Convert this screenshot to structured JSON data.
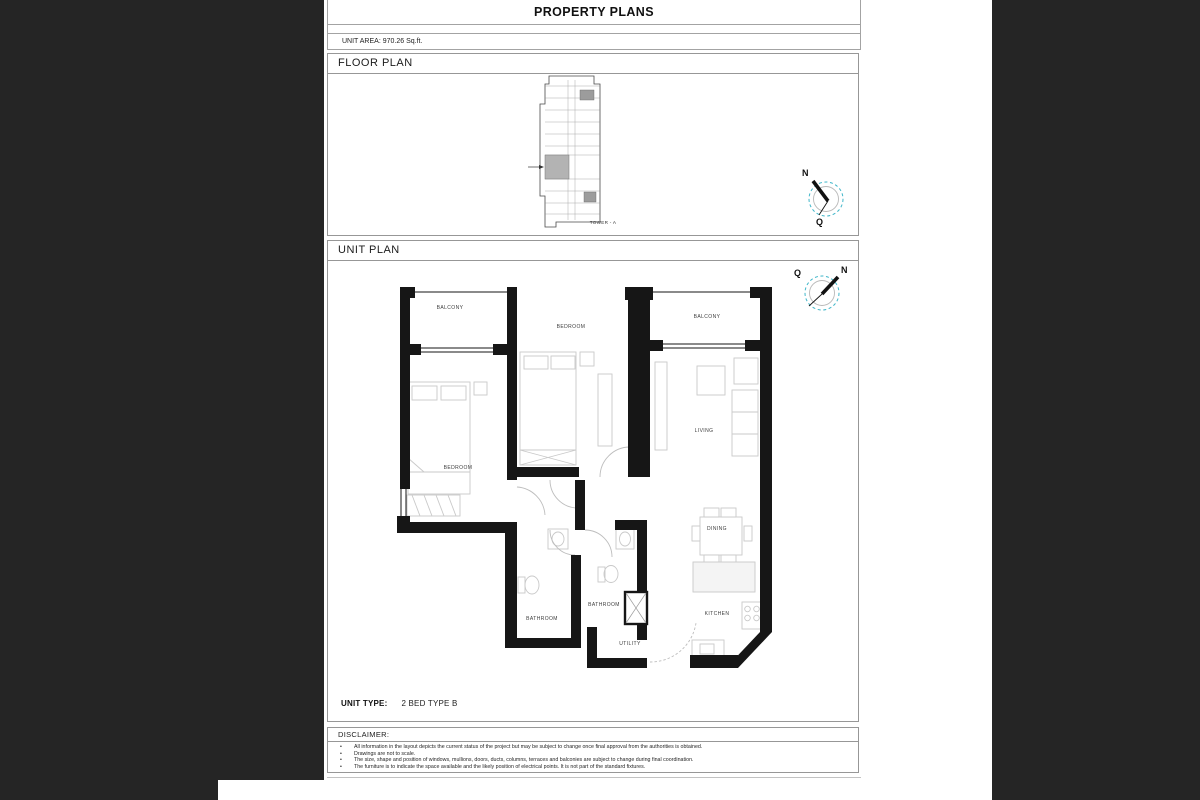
{
  "doc": {
    "title": "PROPERTY PLANS",
    "unit_area": "UNIT AREA: 970.26 Sq.ft.",
    "floor_plan": {
      "header": "FLOOR PLAN",
      "tower_label": "TOWER - A",
      "compass": {
        "north": "N",
        "qibla": "Q"
      }
    },
    "unit_plan": {
      "header": "UNIT PLAN",
      "compass": {
        "north": "N",
        "qibla": "Q"
      },
      "rooms": {
        "balcony_left": "BALCONY",
        "bedroom_middle": "BEDROOM",
        "balcony_right": "BALCONY",
        "living": "LIVING",
        "bedroom_left": "BEDROOM",
        "dining": "DINING",
        "bathroom_1": "BATHROOM",
        "bathroom_2": "BATHROOM",
        "kitchen": "KITCHEN",
        "utility": "UTILITY"
      },
      "unit_type_label": "UNIT TYPE:",
      "unit_type_value": "2 BED TYPE B"
    },
    "disclaimer": {
      "header": "DISCLAIMER:",
      "bullet_glyph": "•",
      "bullets": [
        "All information in the layout depicts the current status of the project but may be subject to change once final approval from the authorities is obtained.",
        "Drawings are not to scale.",
        "The size, shape and position of windows, mullions, doors, ducts, columns, terraces and balconies are subject to change during final coordination.",
        "The furniture is to indicate the space available and the likely position of electrical points. It is not part of the standard fixtures."
      ]
    },
    "colors": {
      "background": "#252525",
      "compass_accent": "#3fb6c9",
      "walls": "#161616",
      "highlighted_unit": "#b3b3b3"
    }
  }
}
